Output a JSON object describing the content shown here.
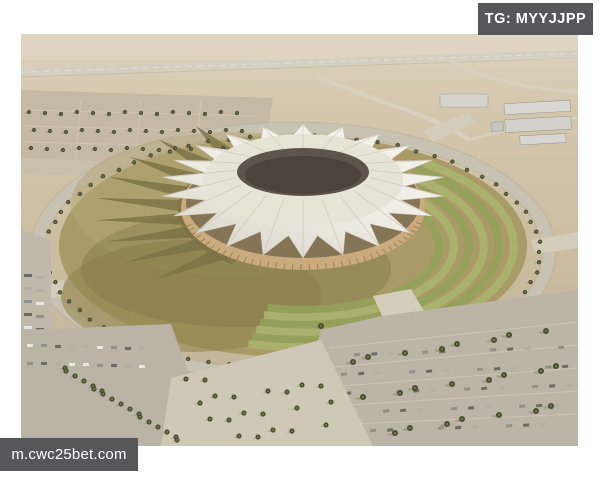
{
  "photo": {
    "alt": "Aerial architectural rendering of a circular stadium with a white tent-crown roof, dark central oculus, olive plaza ring, green terraced lawns, palm-lined ring road, parking lots and desert surroundings"
  },
  "watermarks": {
    "telegram": "TG: MYYJJPP",
    "website": "m.cwc25bet.com"
  },
  "colors": {
    "badge_bg": "#57575a",
    "badge_text": "#ffffff",
    "frame_bg": "#ffffff",
    "sand_light": "#ddd4c0",
    "sand": "#cbbc9f",
    "sand_dark": "#bfb29b",
    "roof_white": "#f6f4ee",
    "roof_shade": "#d7d3c7",
    "oculus_dark": "#5d544b",
    "oculus_deep": "#4b433c",
    "facade_wood": "#c9ab7e",
    "plaza_olive": "#a99a68",
    "plaza_tan": "#b5a677",
    "shadow_olive": "#7a7045",
    "lawn_green_dark": "#94a05a",
    "lawn_green_light": "#aab26e",
    "road_gray": "#c8c2b3",
    "walkway": "#d4cdbb",
    "parking_gray": "#bcb5a7",
    "palm_green": "#4d5134",
    "palm_light": "#76814a",
    "tree_shadow": "#8d8468",
    "building_gray": "#d9d7d1"
  }
}
